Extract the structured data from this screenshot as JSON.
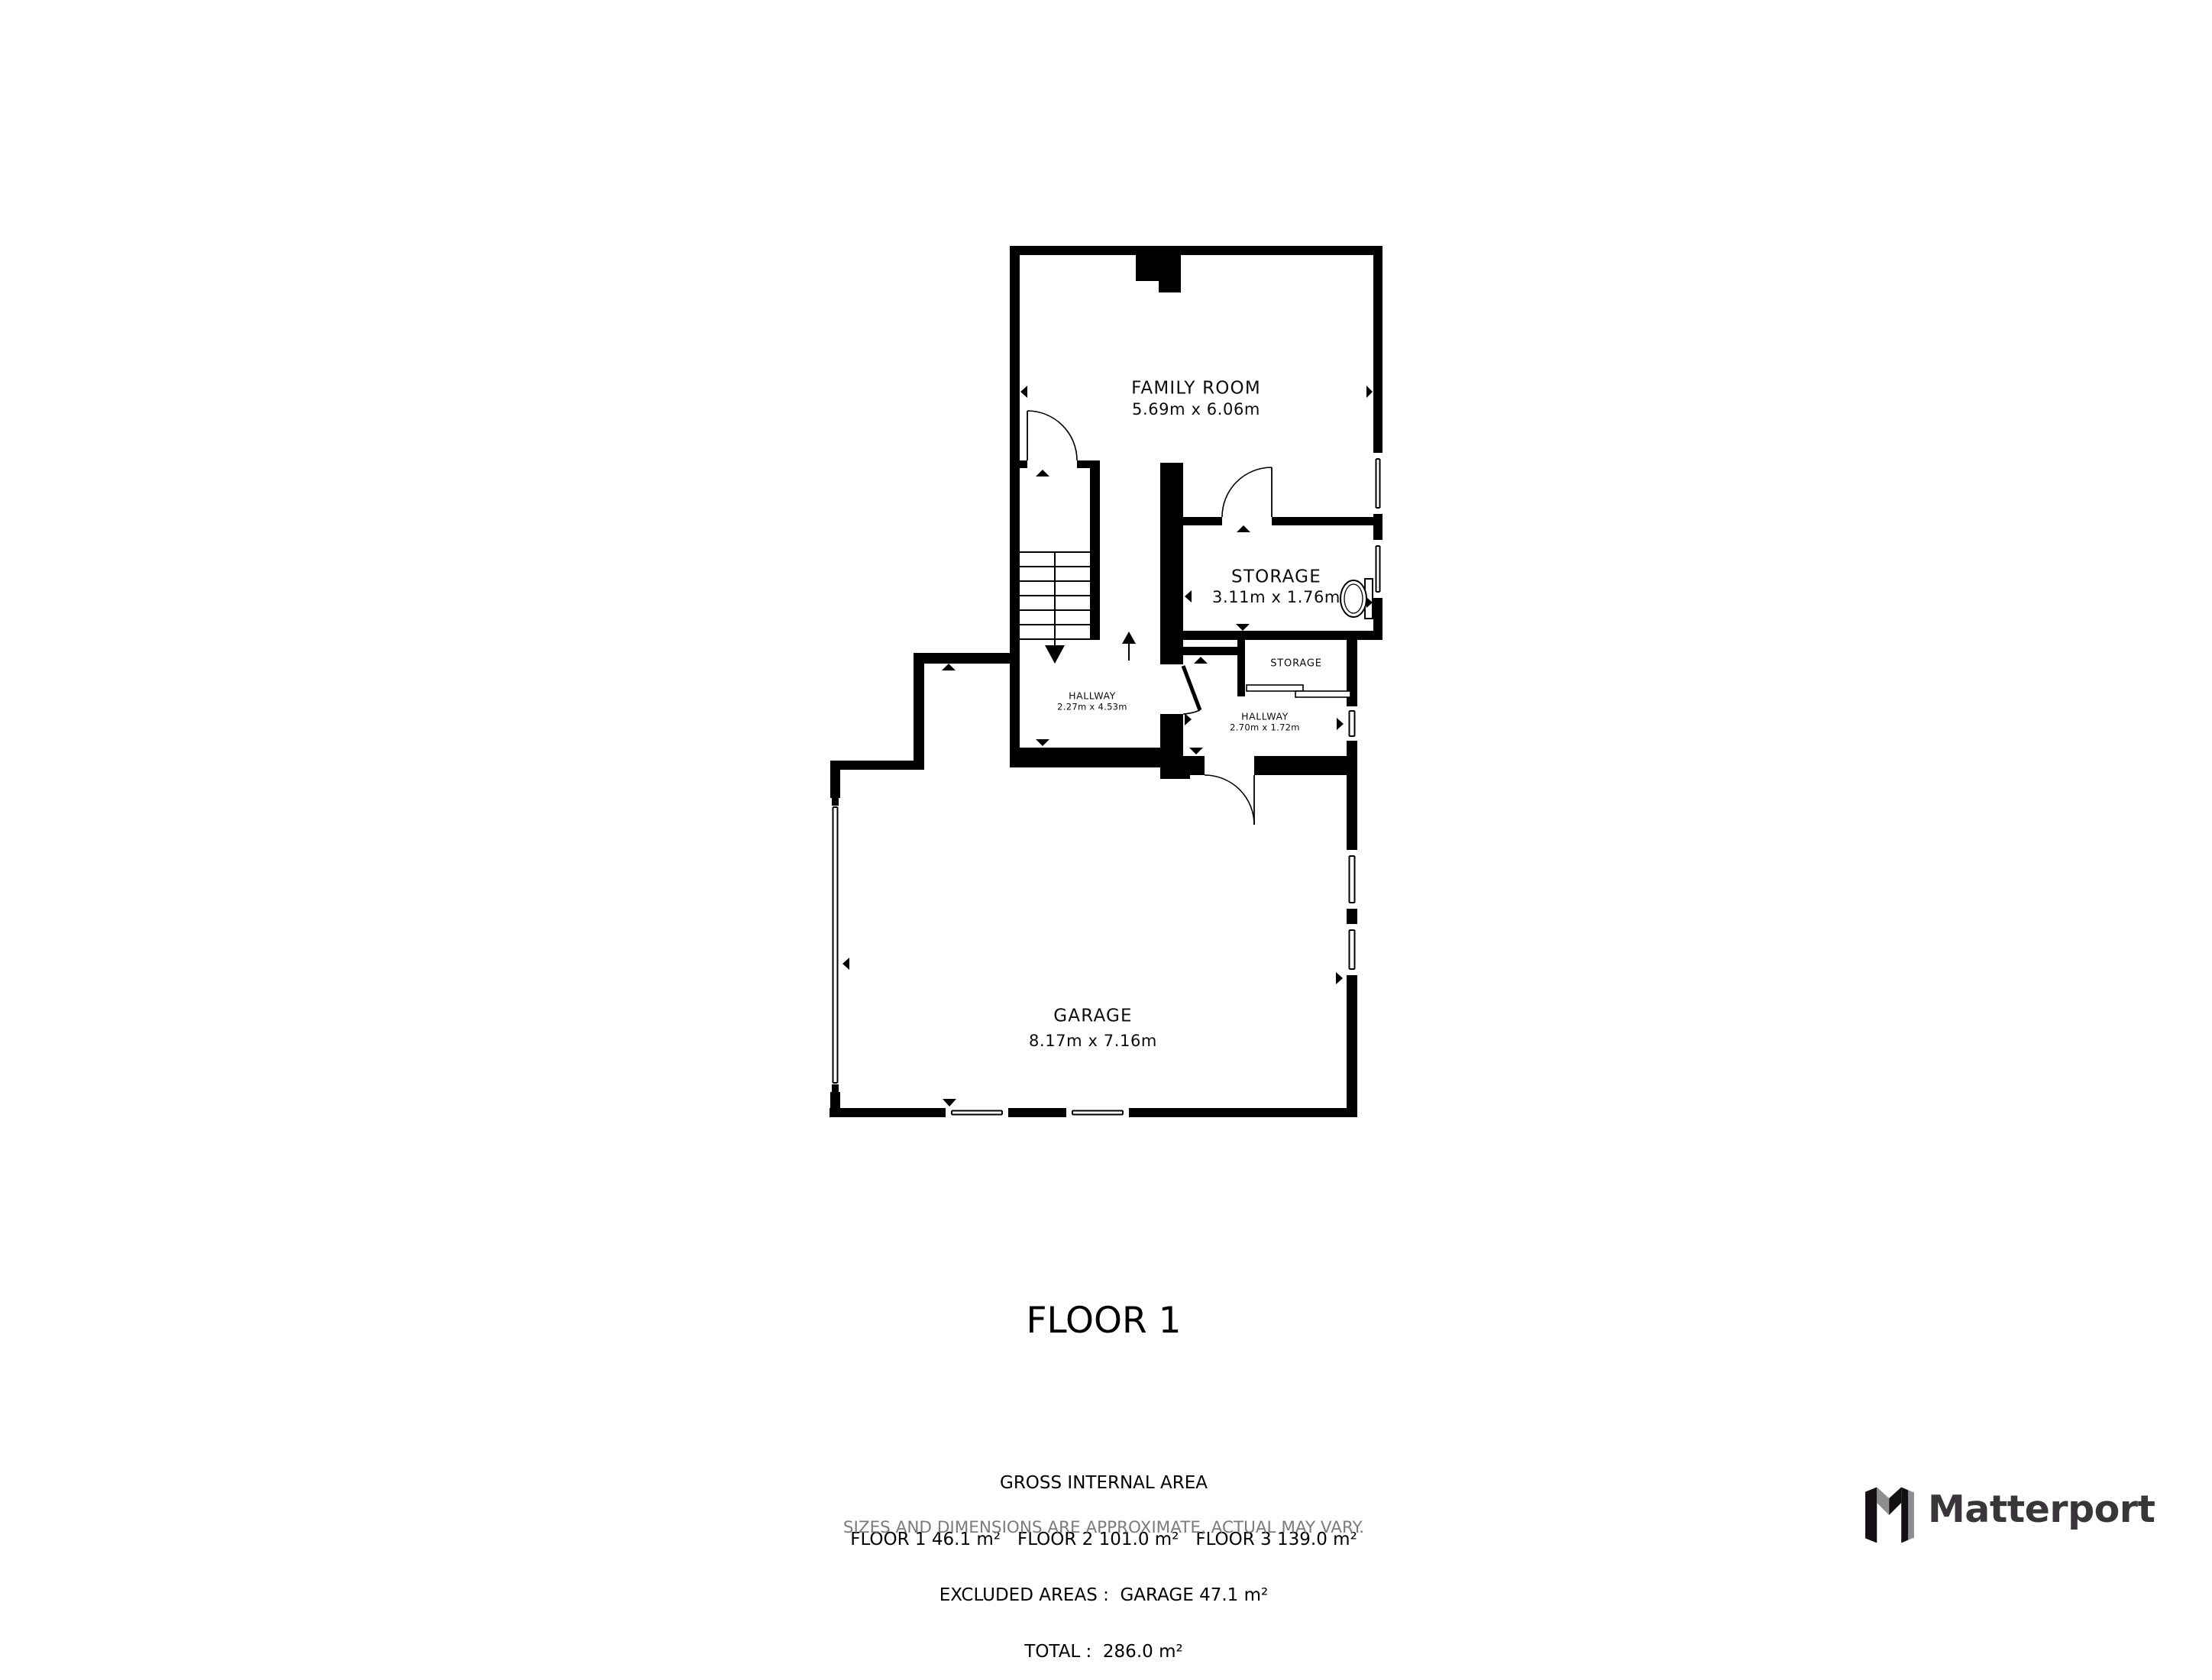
{
  "plan": {
    "wall_color": "#000000",
    "rooms": [
      {
        "name": "FAMILY ROOM",
        "dimensions": "5.69m x 6.06m"
      },
      {
        "name": "STORAGE",
        "dimensions": "3.11m x 1.76m"
      },
      {
        "name": "STORAGE",
        "dimensions": ""
      },
      {
        "name": "HALLWAY",
        "dimensions": "2.27m x 4.53m"
      },
      {
        "name": "HALLWAY",
        "dimensions": "2.70m x 1.72m"
      },
      {
        "name": "GARAGE",
        "dimensions": "8.17m x 7.16m"
      }
    ]
  },
  "floor_label": {
    "title": "FLOOR 1"
  },
  "area_summary": {
    "heading": "GROSS INTERNAL AREA",
    "floors_line": "FLOOR 1 46.1 m²   FLOOR 2 101.0 m²   FLOOR 3 139.0 m²",
    "excluded_line": "EXCLUDED AREAS :  GARAGE 47.1 m²",
    "total_line": "TOTAL :  286.0 m²",
    "disclaimer": "SIZES AND DIMENSIONS ARE APPROXIMATE, ACTUAL MAY VARY.",
    "disclaimer_color": "#7c7c7c"
  },
  "branding": {
    "logo_text": "Matterport",
    "logo_dark": "#131013",
    "logo_gray": "#8e8d90"
  }
}
